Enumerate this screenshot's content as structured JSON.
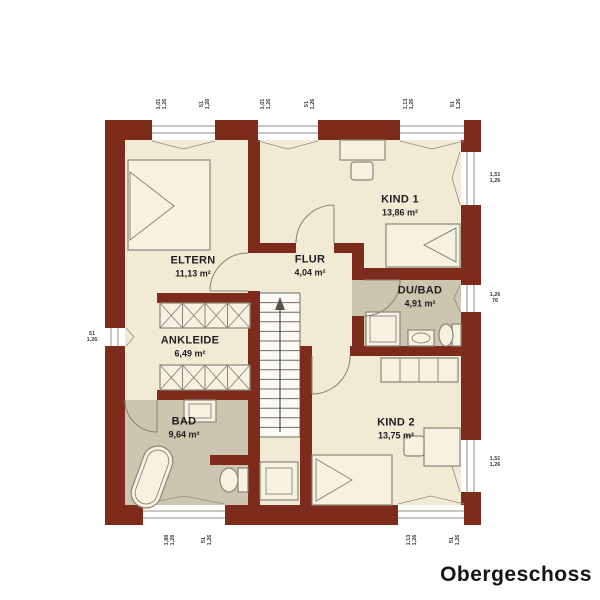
{
  "title": "Obergeschoss",
  "colors": {
    "wall": "#7d2c1c",
    "floor": "#f1ebd6",
    "wet_floor": "#ccc5b0",
    "furniture_line": "#8a8677",
    "text": "#1e1e1e"
  },
  "rooms": [
    {
      "name": "ELTERN",
      "area": "11,13 m²"
    },
    {
      "name": "KIND 1",
      "area": "13,86 m²"
    },
    {
      "name": "FLUR",
      "area": "4,04 m²"
    },
    {
      "name": "DU/BAD",
      "area": "4,91 m²"
    },
    {
      "name": "ANKLEIDE",
      "area": "6,49 m²"
    },
    {
      "name": "BAD",
      "area": "9,64 m²"
    },
    {
      "name": "KIND 2",
      "area": "13,75 m²"
    }
  ],
  "windows": [
    {
      "label": "1,01\n1,26"
    },
    {
      "label": "51\n1,26"
    },
    {
      "label": "1,01\n1,26"
    },
    {
      "label": "51\n1,26"
    },
    {
      "label": "1,13\n1,26"
    },
    {
      "label": "51\n1,26"
    },
    {
      "label": "1,51\n1,26"
    },
    {
      "label": "1,26\n76"
    },
    {
      "label": "1,51\n1,26"
    },
    {
      "label": "51\n1,26"
    },
    {
      "label": "1,88\n1,26"
    },
    {
      "label": "51\n1,26"
    },
    {
      "label": "1,13\n1,26"
    },
    {
      "label": "51\n1,26"
    }
  ]
}
